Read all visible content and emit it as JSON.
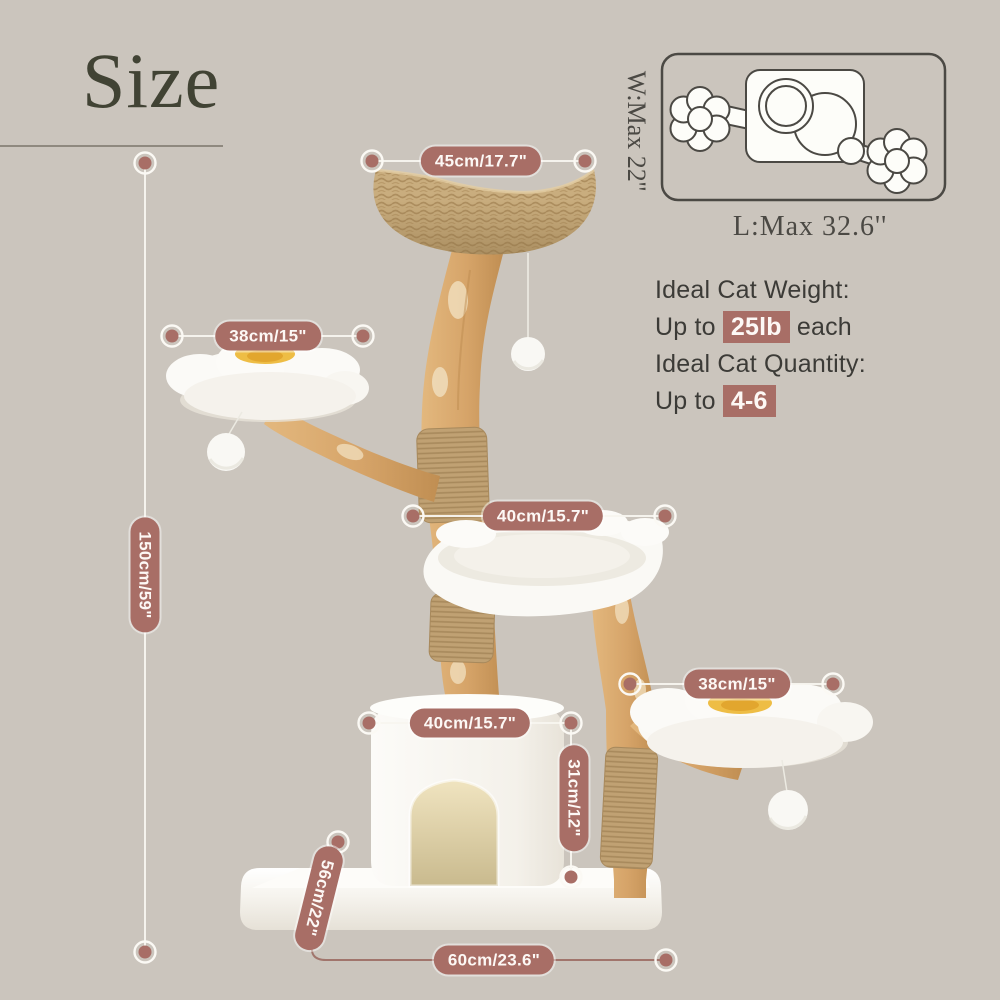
{
  "header": {
    "title": "Size"
  },
  "footprint_diagram": {
    "width_label": "W:Max 22''",
    "length_label": "L:Max 32.6''"
  },
  "cat_info": {
    "weight_label": "Ideal Cat Weight:",
    "weight_prefix": "Up to ",
    "weight_value": "25lb",
    "weight_suffix": " each",
    "quantity_label": "Ideal Cat Quantity:",
    "quantity_prefix": "Up to ",
    "quantity_value": "4-6"
  },
  "dimensions": {
    "top_perch_width": "45cm/17.7\"",
    "left_perch_width": "38cm/15\"",
    "total_height": "150cm/59\"",
    "hammock_width": "40cm/15.7\"",
    "right_perch_width": "38cm/15\"",
    "condo_width": "40cm/15.7\"",
    "condo_height": "31cm/12\"",
    "base_depth": "56cm/22\"",
    "base_width": "60cm/23.6\""
  },
  "colors": {
    "background": "#cbc5bd",
    "accent_rose": "#a86e66",
    "title_olive": "#414334",
    "diagram_stroke": "#4b4944",
    "wood": "#d9ab72",
    "jute": "#c0a173",
    "plush_white": "#faf9f5",
    "flower_yellow": "#eebd45"
  }
}
